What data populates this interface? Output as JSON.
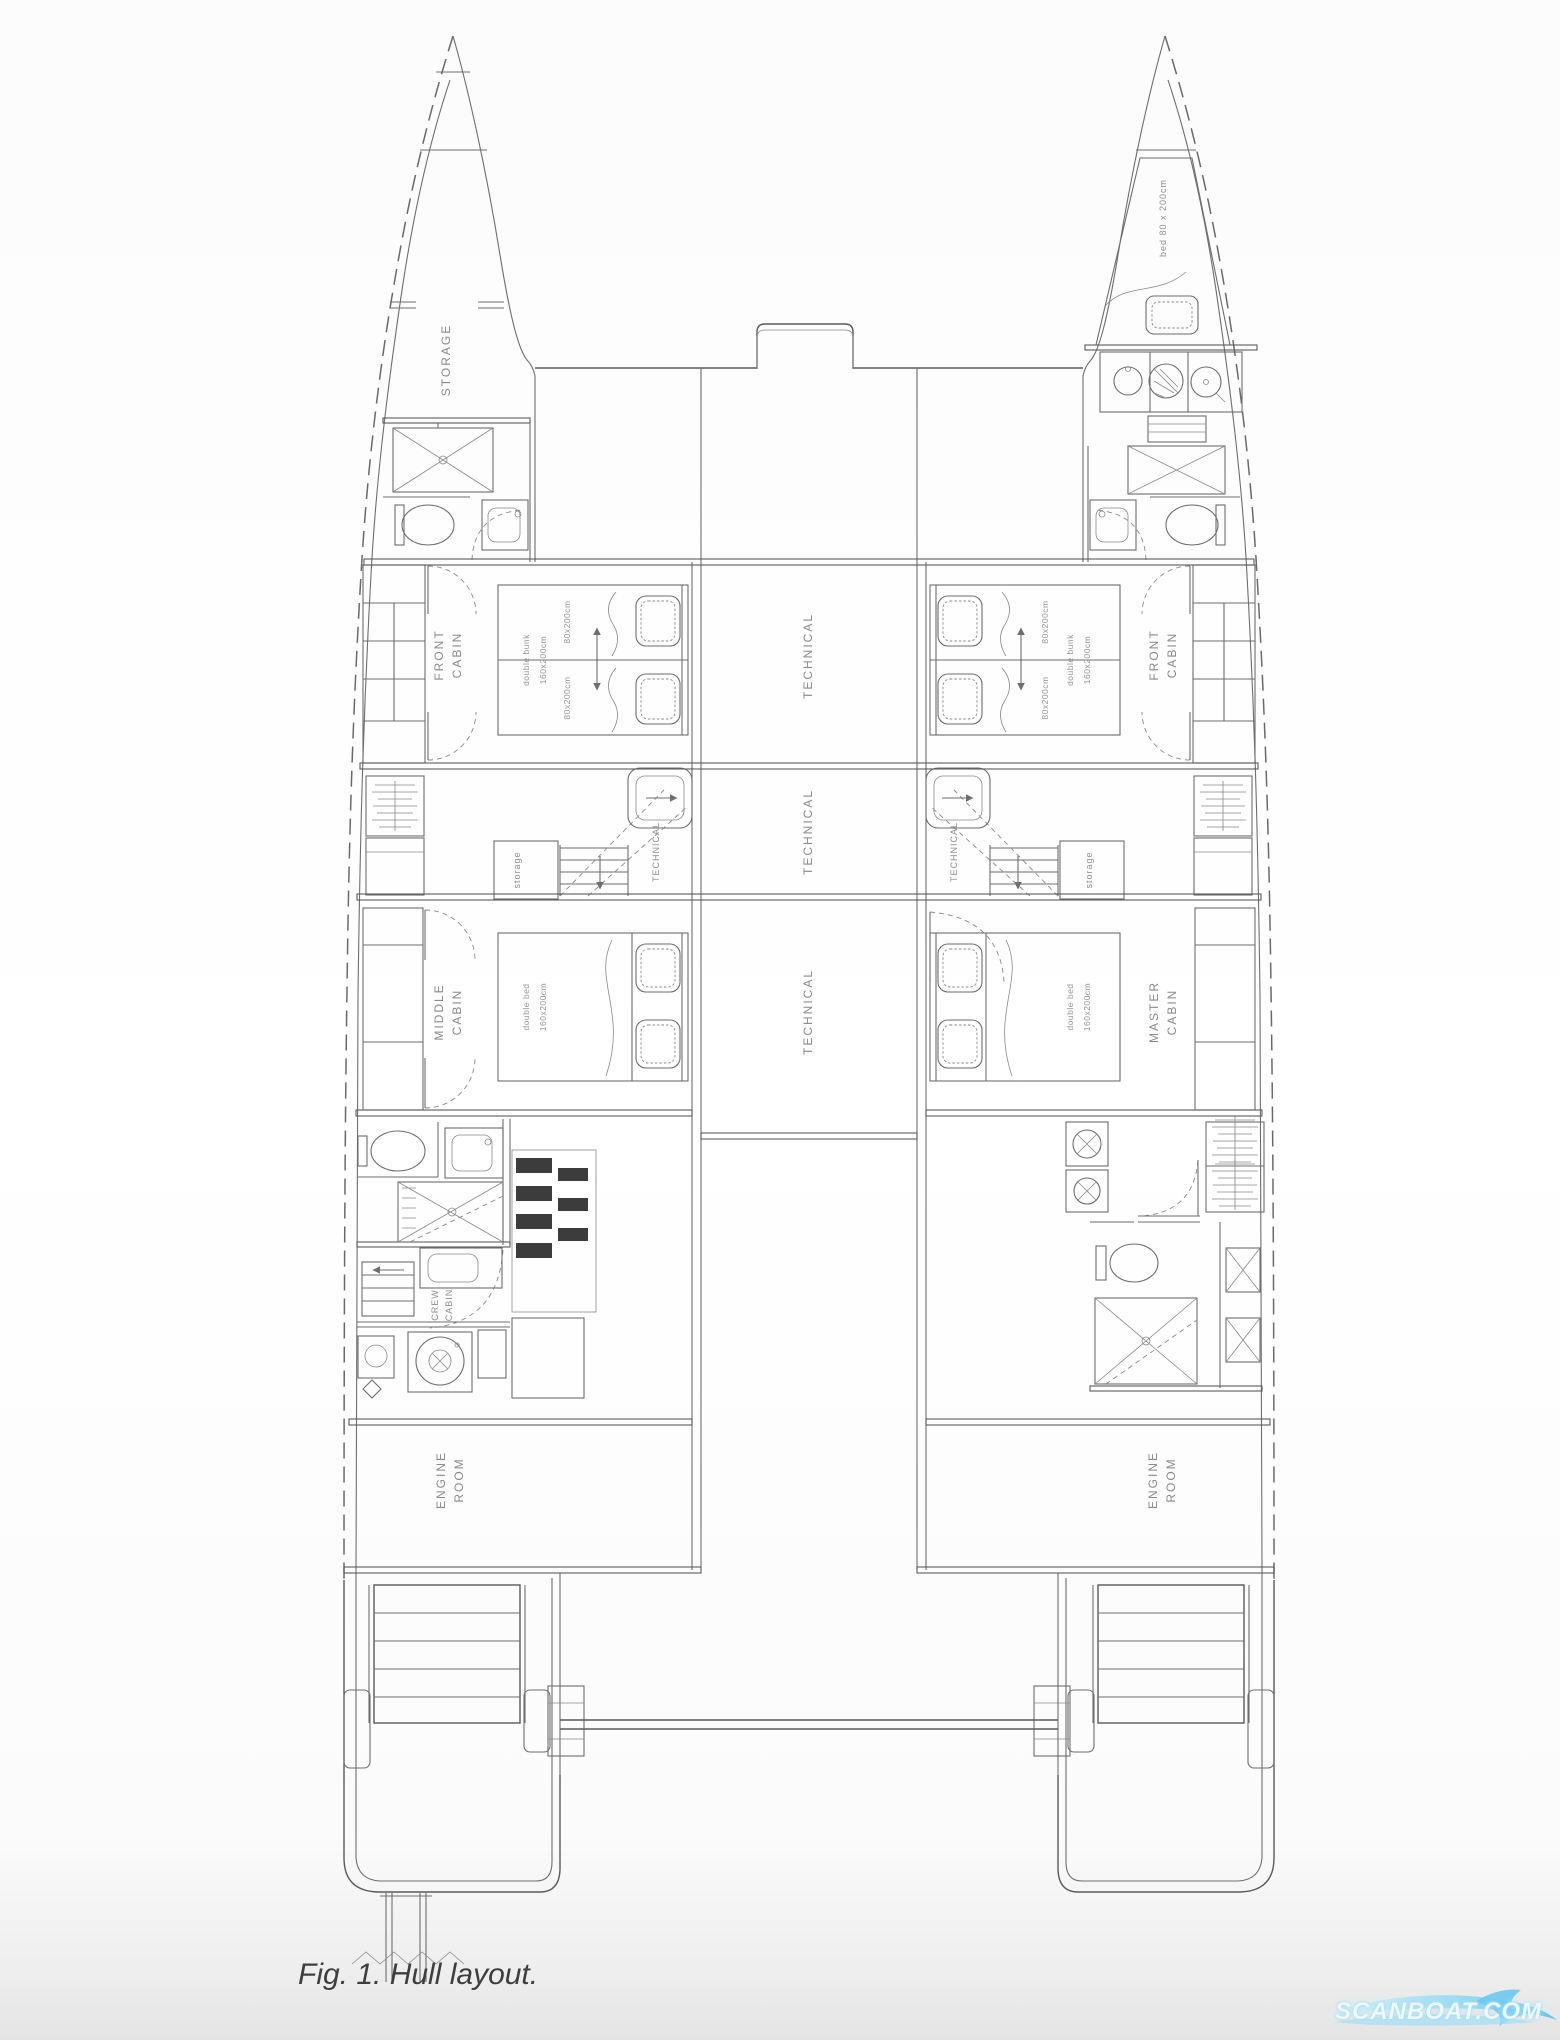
{
  "figure": {
    "caption": "Fig. 1. Hull layout.",
    "watermark": "SCANBOAT.COM"
  },
  "rooms": {
    "storage_bow": "STORAGE",
    "front_cabin_1": "FRONT",
    "front_cabin_2": "CABIN",
    "middle_cabin_1": "MIDDLE",
    "middle_cabin_2": "CABIN",
    "master_cabin_1": "MASTER",
    "master_cabin_2": "CABIN",
    "crew_cabin_1": "CREW",
    "crew_cabin_2": "CABIN",
    "engine_room_1": "ENGINE",
    "engine_room_2": "ROOM",
    "technical": "TECHNICAL",
    "storage_small": "storage"
  },
  "beds": {
    "bow_bed": "bed 80 x 200cm",
    "single_size": "80x200cm",
    "double_bunk_1": "double bunk",
    "double_bunk_2": "160x200cm",
    "double_bed_1": "double bed",
    "double_bed_2": "160x200cm"
  },
  "colors": {
    "line": "#6e6e6e",
    "label": "#8a8a8a",
    "caption": "#3e3e3e",
    "watermark_blue": "#7fd4f4"
  }
}
